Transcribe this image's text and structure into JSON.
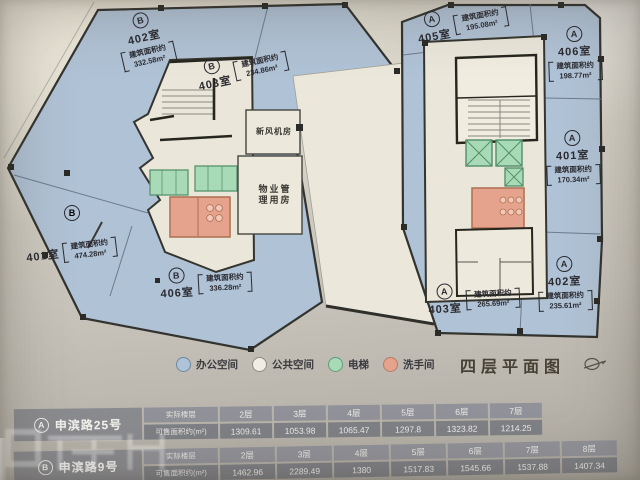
{
  "title": {
    "text": "四层平面图"
  },
  "legend": {
    "items": [
      {
        "label": "办公空间",
        "color": "#aec3d9"
      },
      {
        "label": "公共空间",
        "color": "#f0ede2"
      },
      {
        "label": "电梯",
        "color": "#a6dbb6"
      },
      {
        "label": "洗手间",
        "color": "#e8a28c"
      }
    ]
  },
  "plan": {
    "marker_b": "B",
    "utility": [
      {
        "name": "新风机房"
      },
      {
        "name": "物业管理用房"
      }
    ],
    "rooms": [
      {
        "building": "B",
        "name": "402室",
        "area_label": "建筑面积约",
        "area": "332.58m²"
      },
      {
        "building": "B",
        "name": "403室",
        "area_label": "建筑面积约",
        "area": "234.86m²"
      },
      {
        "building": "B",
        "name": "401室",
        "area_label": "建筑面积约",
        "area": "474.28m²"
      },
      {
        "building": "B",
        "name": "406室",
        "area_label": "建筑面积约",
        "area": "336.28m²"
      },
      {
        "building": "A",
        "name": "405室",
        "area_label": "建筑面积约",
        "area": "195.08m²"
      },
      {
        "building": "A",
        "name": "406室",
        "area_label": "建筑面积约",
        "area": "198.77m²"
      },
      {
        "building": "A",
        "name": "401室",
        "area_label": "建筑面积约",
        "area": "170.34m²"
      },
      {
        "building": "A",
        "name": "402室",
        "area_label": "建筑面积约",
        "area": "235.61m²"
      },
      {
        "building": "A",
        "name": "403室",
        "area_label": "建筑面积约",
        "area": "265.69m²"
      }
    ]
  },
  "tables": [
    {
      "building": "A",
      "name": "申滨路25号",
      "floor_label": "实际楼层",
      "area_label": "可售面积约(m²)",
      "floors": [
        "2层",
        "3层",
        "4层",
        "5层",
        "6层",
        "7层"
      ],
      "areas": [
        "1309.61",
        "1053.98",
        "1065.47",
        "1297.8",
        "1323.82",
        "1214.25"
      ]
    },
    {
      "building": "B",
      "name": "申滨路9号",
      "floor_label": "实际楼层",
      "area_label": "可售面积约(m²)",
      "floors": [
        "2层",
        "3层",
        "4层",
        "5层",
        "6层",
        "7层",
        "8层"
      ],
      "areas": [
        "1462.96",
        "2289.49",
        "1380",
        "1517.83",
        "1545.66",
        "1537.88",
        "1407.34"
      ]
    }
  ],
  "colors": {
    "office_space": "#aec3d9",
    "public_space": "#f0ede2",
    "elevator": "#a6dbb6",
    "restroom": "#e8a28c",
    "walls": "#33332f",
    "paper": "#cdc9bf",
    "table_cell": "#85878b"
  }
}
